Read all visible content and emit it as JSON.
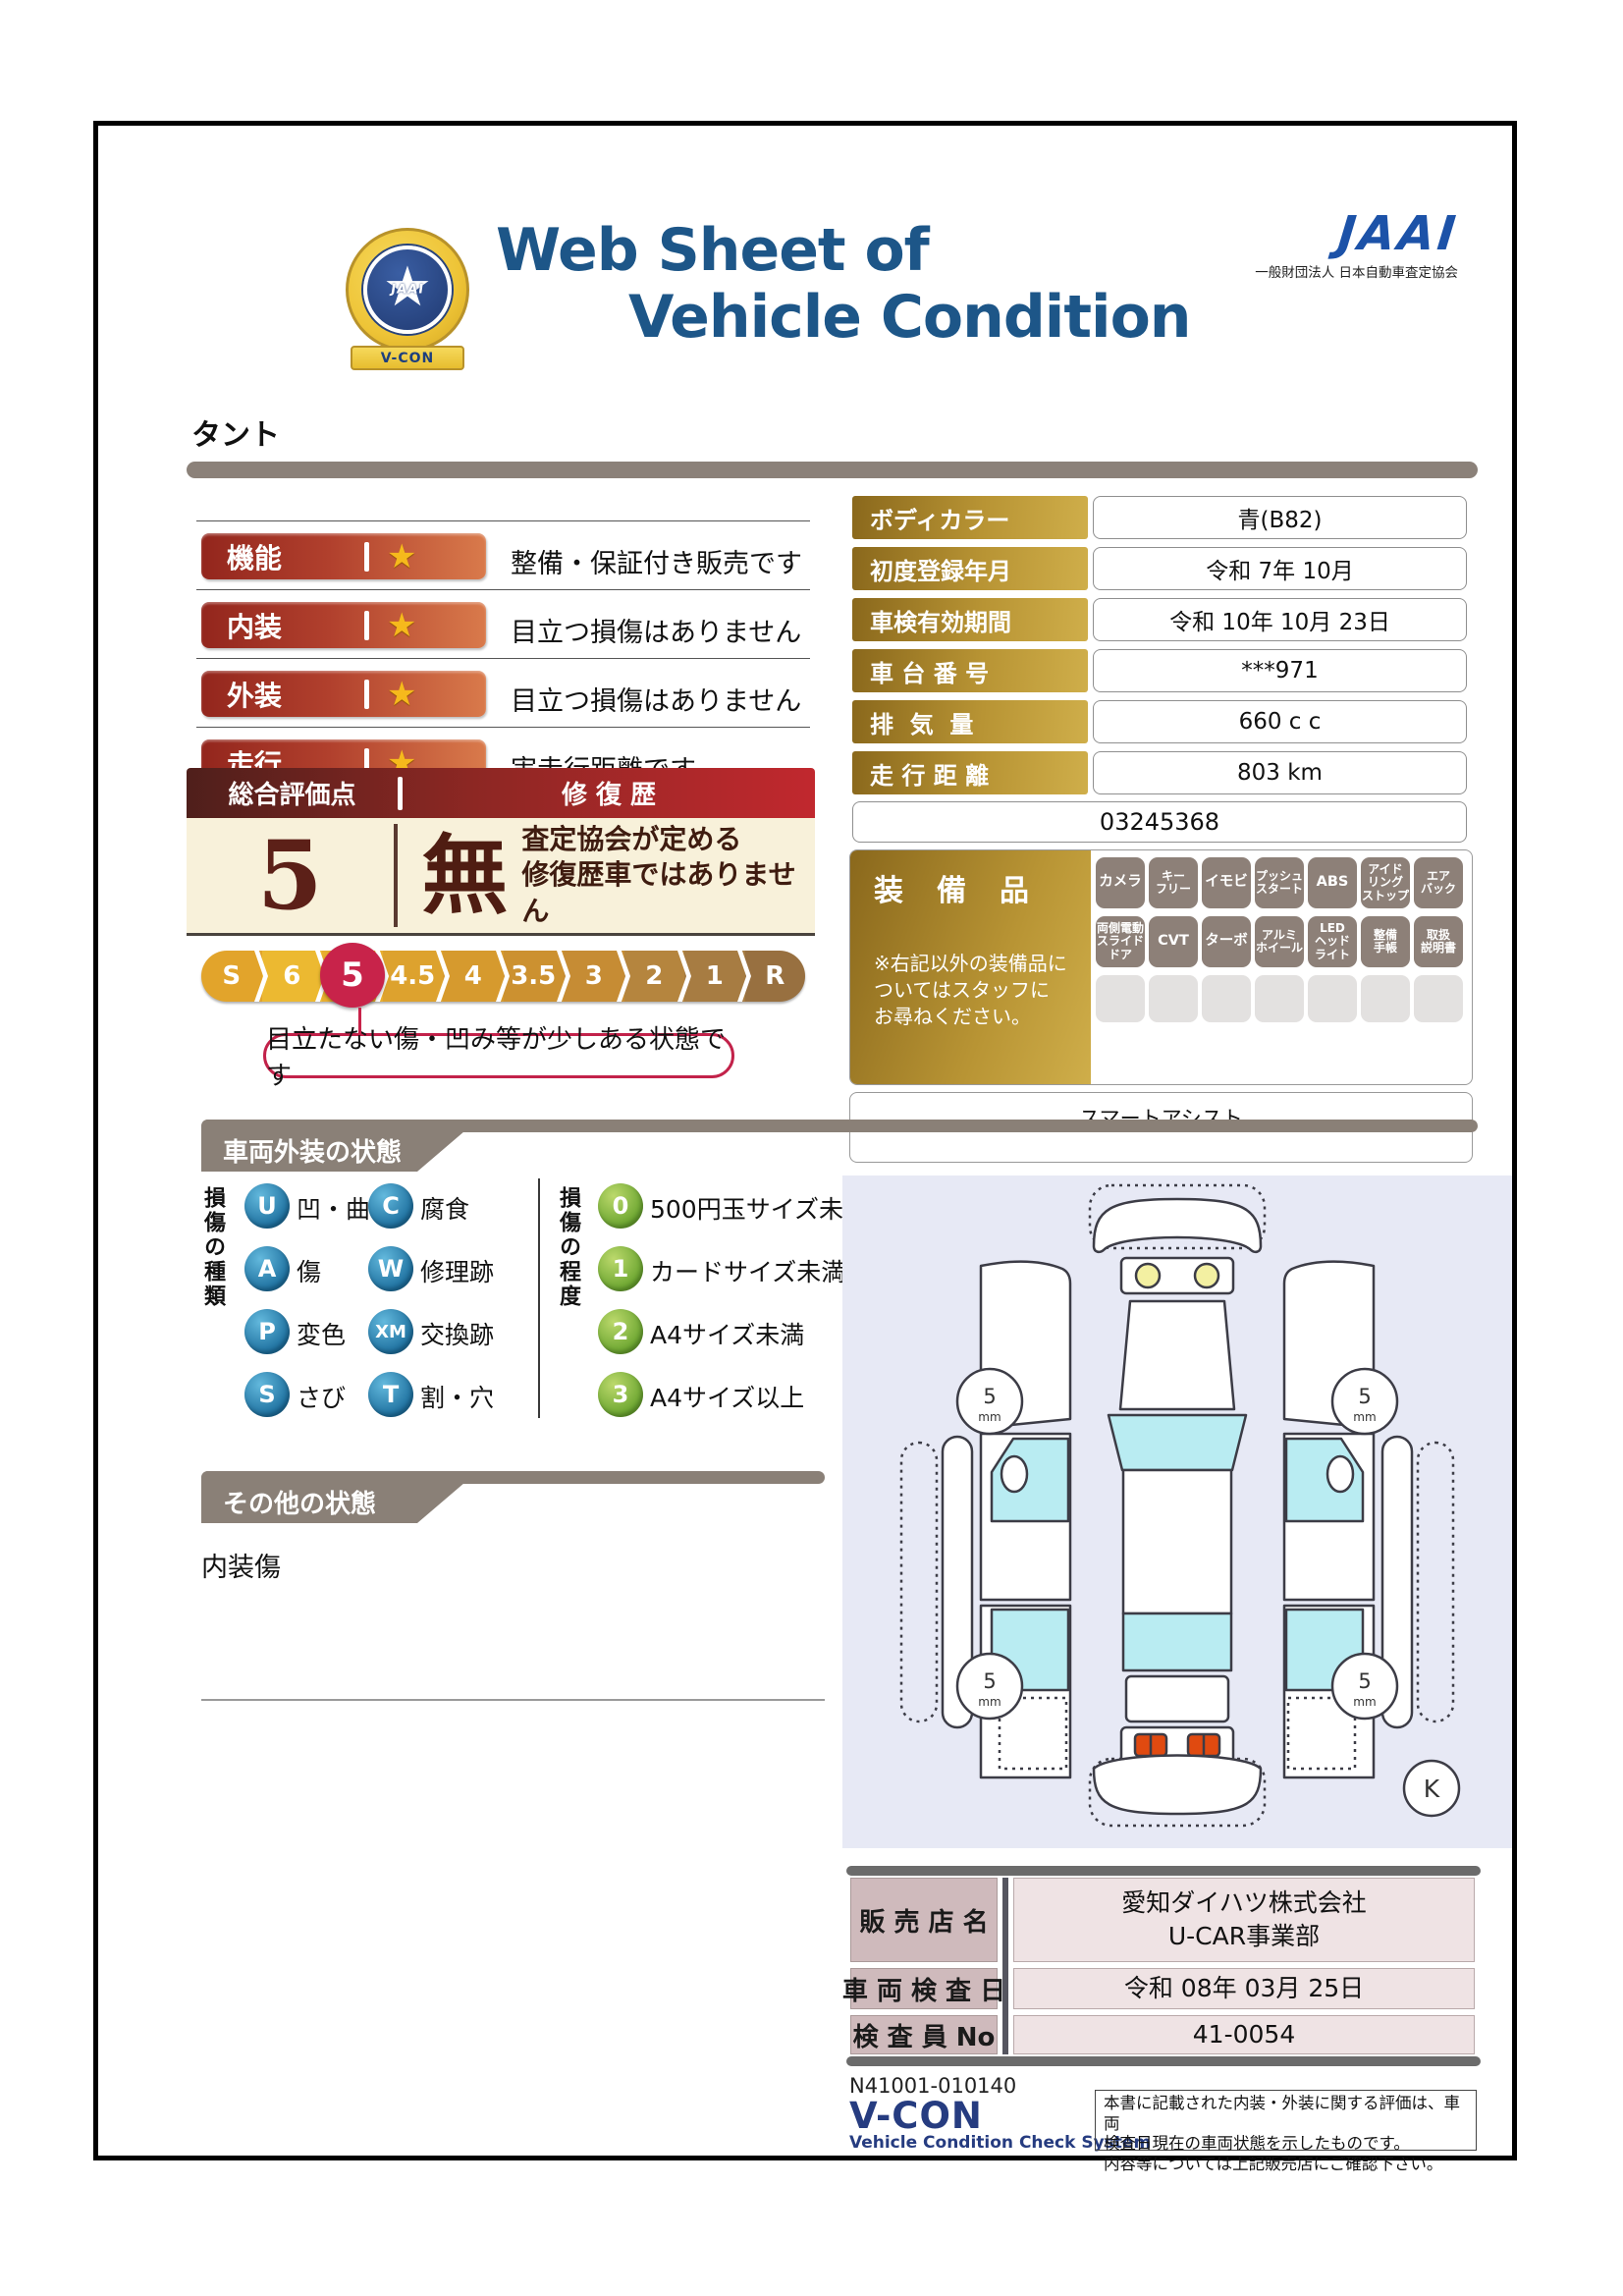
{
  "header": {
    "badge_jaai": "JAAI",
    "badge_ribbon": "V-CON",
    "title_line1": "Web Sheet of",
    "title_line2": "Vehicle Condition",
    "jaai_logo": "JAAI",
    "jaai_subtitle": "一般財団法人 日本自動車査定協会"
  },
  "vehicle_name": "タント",
  "ratings": {
    "star": "★",
    "rows": [
      {
        "label": "機能",
        "desc": "整備・保証付き販売です"
      },
      {
        "label": "内装",
        "desc": "目立つ損傷はありません"
      },
      {
        "label": "外装",
        "desc": "目立つ損傷はありません"
      },
      {
        "label": "走行",
        "desc": "実走行距離です"
      }
    ]
  },
  "spec": {
    "rows": [
      {
        "label": "ボディカラー",
        "value": "青(B82)"
      },
      {
        "label": "初度登録年月",
        "value": "令和 7年 10月"
      },
      {
        "label": "車検有効期間",
        "value": "令和 10年 10月 23日"
      },
      {
        "label": "車 台 番 号",
        "value": "***971"
      },
      {
        "label": "排  気  量",
        "value": "660 c c"
      },
      {
        "label": "走 行 距 離",
        "value": "803 km"
      }
    ],
    "number": "03245368"
  },
  "overall": {
    "header_left": "総合評価点",
    "header_right": "修 復 歴",
    "score": "5",
    "repair_mark": "無",
    "repair_line1": "査定協会が定める",
    "repair_line2": "修復歴車ではありません"
  },
  "scale": {
    "items": [
      "S",
      "6",
      "5",
      "4.5",
      "4",
      "3.5",
      "3",
      "2",
      "1",
      "R"
    ],
    "selected": "5",
    "callout": "目立たない傷・凹み等が少しある状態です"
  },
  "equipment": {
    "title": "装　備　品",
    "note": "※右記以外の装備品に\nついてはスタッフに\nお尋ねください。",
    "row1": [
      "カメラ",
      "キー\nフリー",
      "イモビ",
      "プッシュ\nスタート",
      "ABS",
      "アイド\nリング\nストップ",
      "エア\nバック"
    ],
    "row2": [
      "両側電動\nスライド\nドア",
      "CVT",
      "ターボ",
      "アルミ\nホイール",
      "LED\nヘッド\nライト",
      "整備\n手帳",
      "取扱\n説明書"
    ],
    "extra": "スマートアシスト"
  },
  "exterior": {
    "section_title": "車両外装の状態",
    "type_title": "損傷の種類",
    "types": [
      {
        "code": "U",
        "label": "凹・曲"
      },
      {
        "code": "A",
        "label": "傷"
      },
      {
        "code": "P",
        "label": "変色"
      },
      {
        "code": "S",
        "label": "さび"
      },
      {
        "code": "C",
        "label": "腐食"
      },
      {
        "code": "W",
        "label": "修理跡"
      },
      {
        "code": "XM",
        "label": "交換跡"
      },
      {
        "code": "T",
        "label": "割・穴"
      }
    ],
    "degree_title": "損傷の程度",
    "degrees": [
      {
        "code": "0",
        "label": "500円玉サイズ未満"
      },
      {
        "code": "1",
        "label": "カードサイズ未満"
      },
      {
        "code": "2",
        "label": "A4サイズ未満"
      },
      {
        "code": "3",
        "label": "A4サイズ以上"
      }
    ]
  },
  "other": {
    "section_title": "その他の状態",
    "note": "内装傷"
  },
  "diagram": {
    "tread_value": "5",
    "tread_unit": "mm",
    "marker": "K"
  },
  "dealer": {
    "rows": [
      {
        "label": "販 売 店 名",
        "value": "愛知ダイハツ株式会社\nU-CAR事業部"
      },
      {
        "label": "車 両 検 査 日",
        "value": "令和 08年 03月 25日"
      },
      {
        "label": "検 査 員 No",
        "value": "41-0054"
      }
    ]
  },
  "footer": {
    "code": "N41001-010140",
    "logo": "V-CON",
    "logo_sub": "Vehicle Condition Check System",
    "disclaimer": "本書に記載された内装・外装に関する評価は、車両\n検査日現在の車両状態を示したものです。\n内容等については上記販売店にご確認下さい。"
  },
  "colors": {
    "title_blue": "#1d5688",
    "jaai_blue": "#1c52a8",
    "rating_red": "#9c2b24",
    "gold": "#b89434",
    "score_maroon": "#5c2018",
    "scale_selected": "#c8234a",
    "section_gray": "#8a8077",
    "legend_blue": "#1d7fb0",
    "legend_green": "#7cb33e",
    "diagram_bg": "#e7e9f5",
    "dealer_label_bg": "#cfbabc",
    "dealer_value_bg": "#efe3e4",
    "footer_navy": "#263c80"
  }
}
